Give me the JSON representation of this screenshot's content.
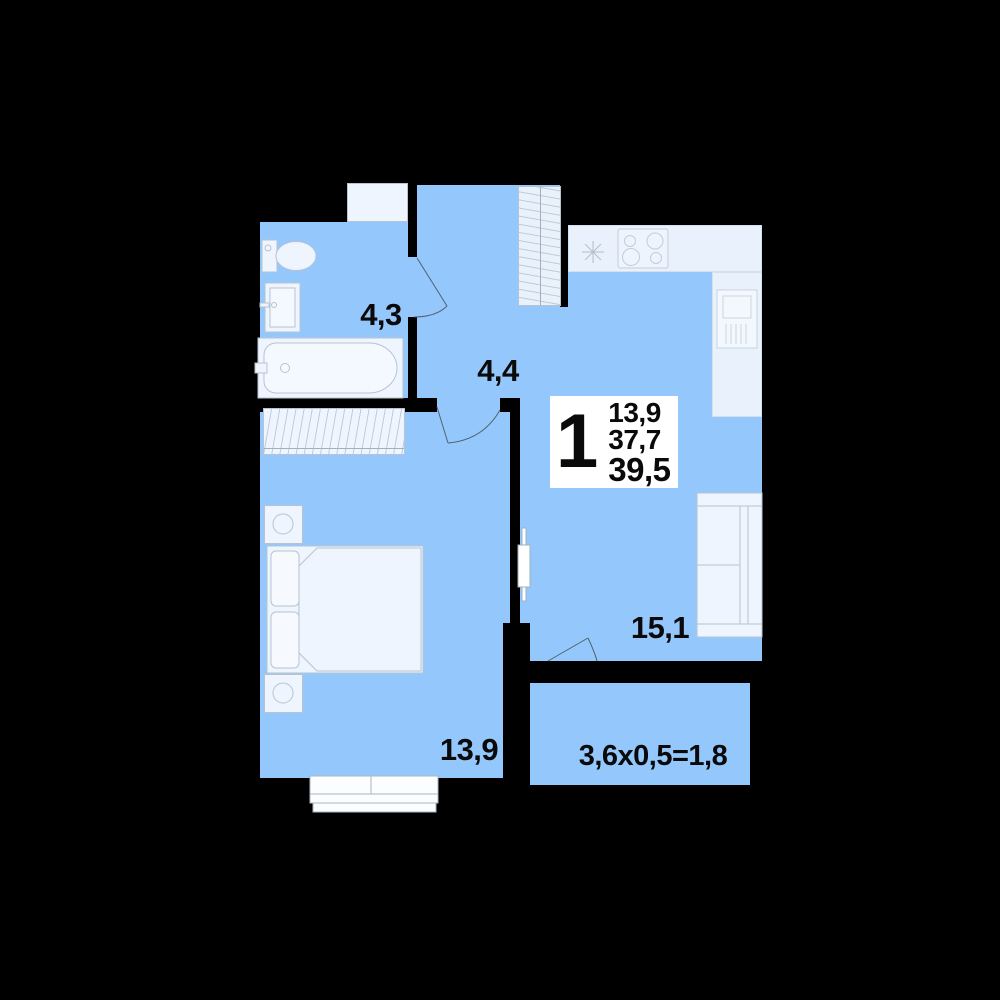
{
  "plan": {
    "background_color": "#000000",
    "floor_color": "#94c8fc",
    "fixture_color": "#eef5fe",
    "card_color": "#ffffff",
    "text_color": "#0a0a0a",
    "card": {
      "rooms_count": "1",
      "values": [
        "13,9",
        "37,7",
        "39,5"
      ]
    },
    "rooms": [
      {
        "id": "bathroom",
        "area_label": "4,3"
      },
      {
        "id": "hallway",
        "area_label": "4,4"
      },
      {
        "id": "bedroom",
        "area_label": "13,9"
      },
      {
        "id": "living-kitchen",
        "area_label": "15,1"
      },
      {
        "id": "balcony",
        "area_label": "3,6x0,5=1,8"
      }
    ]
  }
}
